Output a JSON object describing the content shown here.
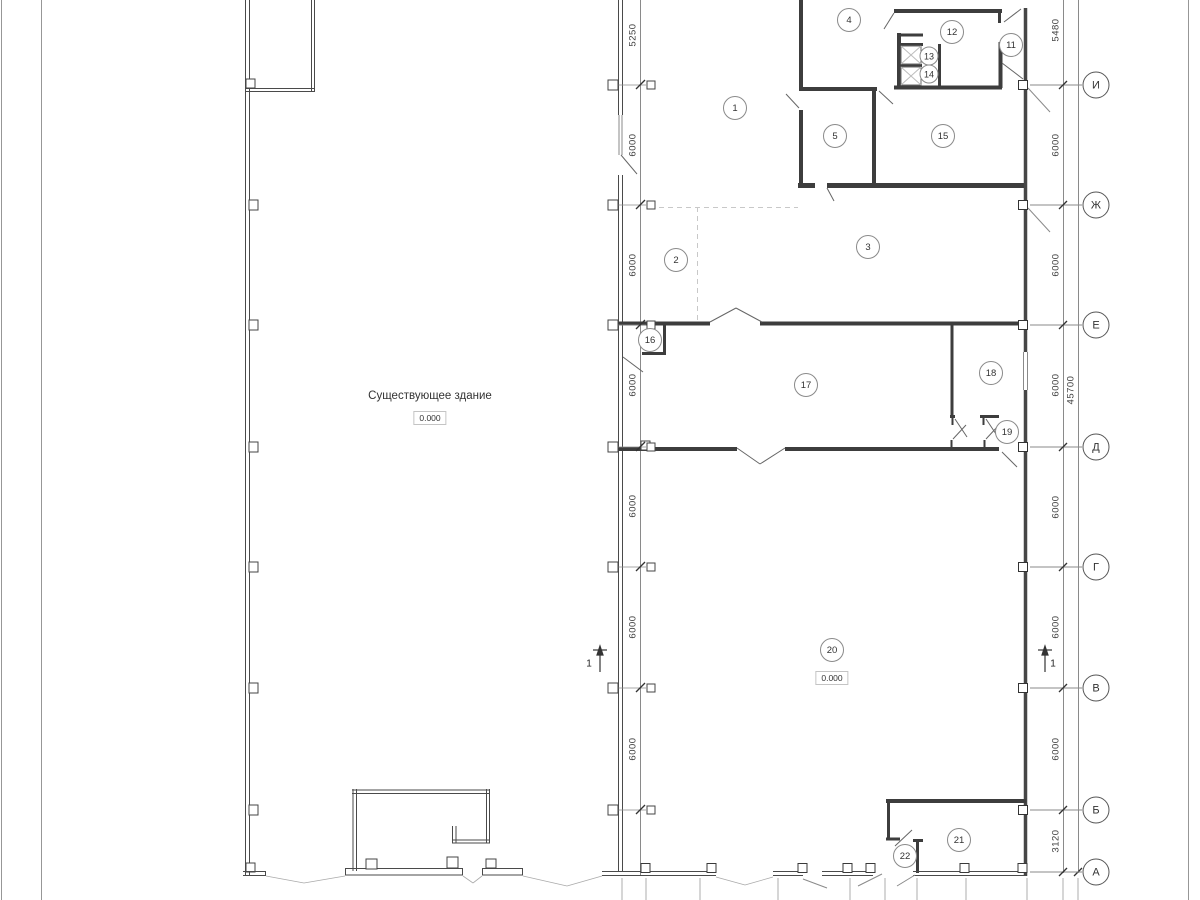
{
  "drawing": {
    "labels": {
      "existing_building": "Существующее здание",
      "elevation_existing": "0.000",
      "elevation_room20": "0.000"
    },
    "rooms": [
      {
        "number": "1",
        "x": 735,
        "y": 108
      },
      {
        "number": "2",
        "x": 676,
        "y": 260
      },
      {
        "number": "3",
        "x": 868,
        "y": 247
      },
      {
        "number": "4",
        "x": 849,
        "y": 20
      },
      {
        "number": "5",
        "x": 835,
        "y": 136
      },
      {
        "number": "11",
        "x": 1011,
        "y": 45
      },
      {
        "number": "12",
        "x": 952,
        "y": 32
      },
      {
        "number": "13",
        "x": 929,
        "y": 56,
        "small": true
      },
      {
        "number": "14",
        "x": 929,
        "y": 74,
        "small": true
      },
      {
        "number": "15",
        "x": 943,
        "y": 136
      },
      {
        "number": "16",
        "x": 650,
        "y": 340
      },
      {
        "number": "17",
        "x": 806,
        "y": 385
      },
      {
        "number": "18",
        "x": 991,
        "y": 373
      },
      {
        "number": "19",
        "x": 1007,
        "y": 432
      },
      {
        "number": "20",
        "x": 832,
        "y": 650
      },
      {
        "number": "21",
        "x": 959,
        "y": 840
      },
      {
        "number": "22",
        "x": 905,
        "y": 856
      }
    ],
    "axes": [
      {
        "label": "И",
        "y": 85
      },
      {
        "label": "Ж",
        "y": 205
      },
      {
        "label": "Е",
        "y": 325
      },
      {
        "label": "Д",
        "y": 447
      },
      {
        "label": "Г",
        "y": 567
      },
      {
        "label": "В",
        "y": 688
      },
      {
        "label": "Б",
        "y": 810
      },
      {
        "label": "А",
        "y": 872
      }
    ],
    "dim_left": [
      {
        "text": "5250",
        "y": 35
      },
      {
        "text": "6000",
        "y": 145
      },
      {
        "text": "6000",
        "y": 265
      },
      {
        "text": "6000",
        "y": 385
      },
      {
        "text": "6000",
        "y": 506
      },
      {
        "text": "6000",
        "y": 627
      },
      {
        "text": "6000",
        "y": 749
      }
    ],
    "dim_right": [
      {
        "text": "5480",
        "y": 30
      },
      {
        "text": "6000",
        "y": 145
      },
      {
        "text": "6000",
        "y": 265
      },
      {
        "text": "6000",
        "y": 385
      },
      {
        "text": "6000",
        "y": 507
      },
      {
        "text": "6000",
        "y": 627
      },
      {
        "text": "6000",
        "y": 749
      },
      {
        "text": "3120",
        "y": 841
      }
    ],
    "dim_overall": {
      "text": "45700",
      "x": 1071,
      "y": 390
    },
    "section_marks": [
      {
        "label": "1",
        "x": 589,
        "y": 664
      },
      {
        "label": "1",
        "x": 1053,
        "y": 664
      }
    ]
  }
}
